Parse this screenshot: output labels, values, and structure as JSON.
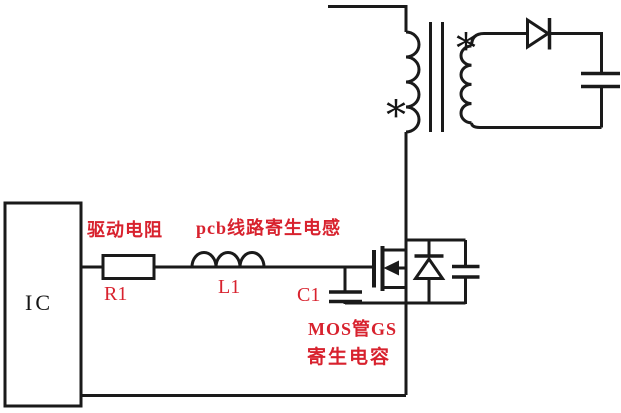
{
  "colors": {
    "line": "#1a1a1a",
    "label_red": "#d8222e",
    "background": "#ffffff"
  },
  "labels": {
    "ic": "IC",
    "drive_resistor": "驱动电阻",
    "r1": "R1",
    "pcb_inductance": "pcb线路寄生电感",
    "l1": "L1",
    "c1": "C1",
    "mos_gs_line1": "MOS管GS",
    "mos_gs_line2": "寄生电容",
    "primary_dot": "*",
    "secondary_dot": "*"
  }
}
